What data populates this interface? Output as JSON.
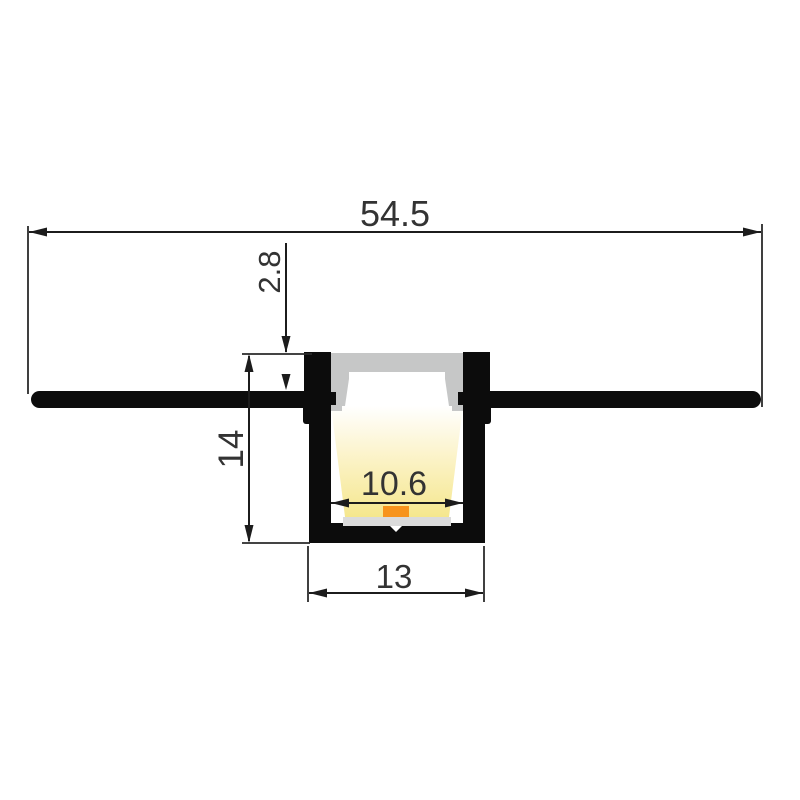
{
  "drawing": {
    "dimensions": {
      "overall_width": "54.5",
      "recess_depth": "2.8",
      "height": "14",
      "inner_width": "10.6",
      "base_width": "13"
    },
    "colors": {
      "background": "#ffffff",
      "profile_black": "#0c0c0c",
      "diffuser_gray": "#c6c7c7",
      "diffuser_inner_white": "#ffffff",
      "pcb_gray": "#dbdbdb",
      "led_orange": "#f7941d",
      "glow_top": "#ffffff",
      "glow_mid": "#fbf2c4",
      "glow_bottom": "#f5e78e"
    }
  }
}
